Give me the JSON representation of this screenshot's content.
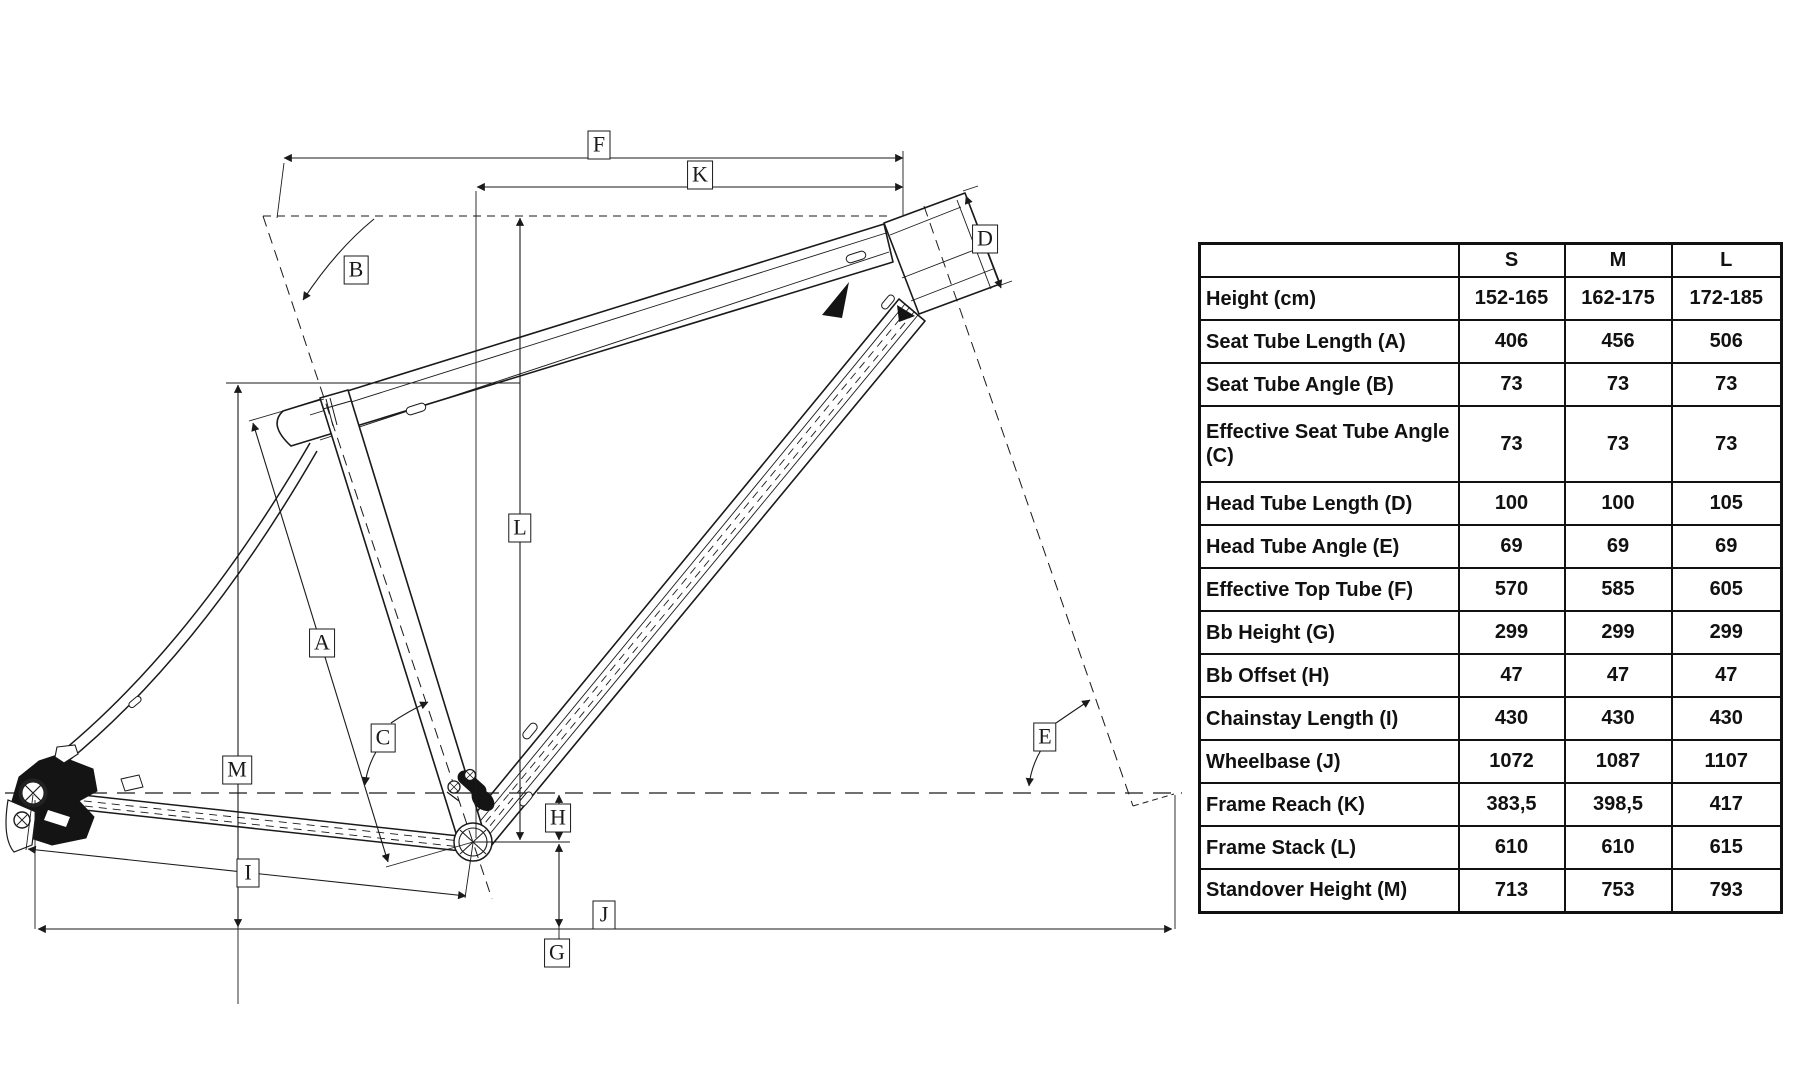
{
  "diagram": {
    "labels": [
      {
        "letter": "F",
        "x": 599,
        "y": 145
      },
      {
        "letter": "K",
        "x": 700,
        "y": 175
      },
      {
        "letter": "B",
        "x": 356,
        "y": 270
      },
      {
        "letter": "D",
        "x": 985,
        "y": 239
      },
      {
        "letter": "L",
        "x": 520,
        "y": 528
      },
      {
        "letter": "A",
        "x": 322,
        "y": 643
      },
      {
        "letter": "C",
        "x": 383,
        "y": 738
      },
      {
        "letter": "M",
        "x": 237,
        "y": 770
      },
      {
        "letter": "E",
        "x": 1045,
        "y": 737
      },
      {
        "letter": "H",
        "x": 558,
        "y": 818
      },
      {
        "letter": "I",
        "x": 248,
        "y": 873
      },
      {
        "letter": "J",
        "x": 604,
        "y": 915
      },
      {
        "letter": "G",
        "x": 557,
        "y": 953
      }
    ]
  },
  "table": {
    "corner": "",
    "size_headers": [
      "S",
      "M",
      "L"
    ],
    "rows": [
      {
        "label": "Height (cm)",
        "values": [
          "152-165",
          "162-175",
          "172-185"
        ],
        "tall": false
      },
      {
        "label": "Seat Tube Length (A)",
        "values": [
          "406",
          "456",
          "506"
        ],
        "tall": false
      },
      {
        "label": "Seat Tube Angle (B)",
        "values": [
          "73",
          "73",
          "73"
        ],
        "tall": false
      },
      {
        "label": "Effective Seat Tube Angle (C)",
        "values": [
          "73",
          "73",
          "73"
        ],
        "tall": true
      },
      {
        "label": "Head Tube Length (D)",
        "values": [
          "100",
          "100",
          "105"
        ],
        "tall": false
      },
      {
        "label": "Head Tube Angle (E)",
        "values": [
          "69",
          "69",
          "69"
        ],
        "tall": false
      },
      {
        "label": "Effective Top Tube (F)",
        "values": [
          "570",
          "585",
          "605"
        ],
        "tall": false
      },
      {
        "label": "Bb Height (G)",
        "values": [
          "299",
          "299",
          "299"
        ],
        "tall": false
      },
      {
        "label": "Bb Offset (H)",
        "values": [
          "47",
          "47",
          "47"
        ],
        "tall": false
      },
      {
        "label": "Chainstay Length (I)",
        "values": [
          "430",
          "430",
          "430"
        ],
        "tall": false
      },
      {
        "label": "Wheelbase (J)",
        "values": [
          "1072",
          "1087",
          "1107"
        ],
        "tall": false
      },
      {
        "label": "Frame Reach (K)",
        "values": [
          "383,5",
          "398,5",
          "417"
        ],
        "tall": false
      },
      {
        "label": "Frame Stack (L)",
        "values": [
          "610",
          "610",
          "615"
        ],
        "tall": false
      },
      {
        "label": "Standover Height (M)",
        "values": [
          "713",
          "753",
          "793"
        ],
        "tall": false
      }
    ]
  }
}
